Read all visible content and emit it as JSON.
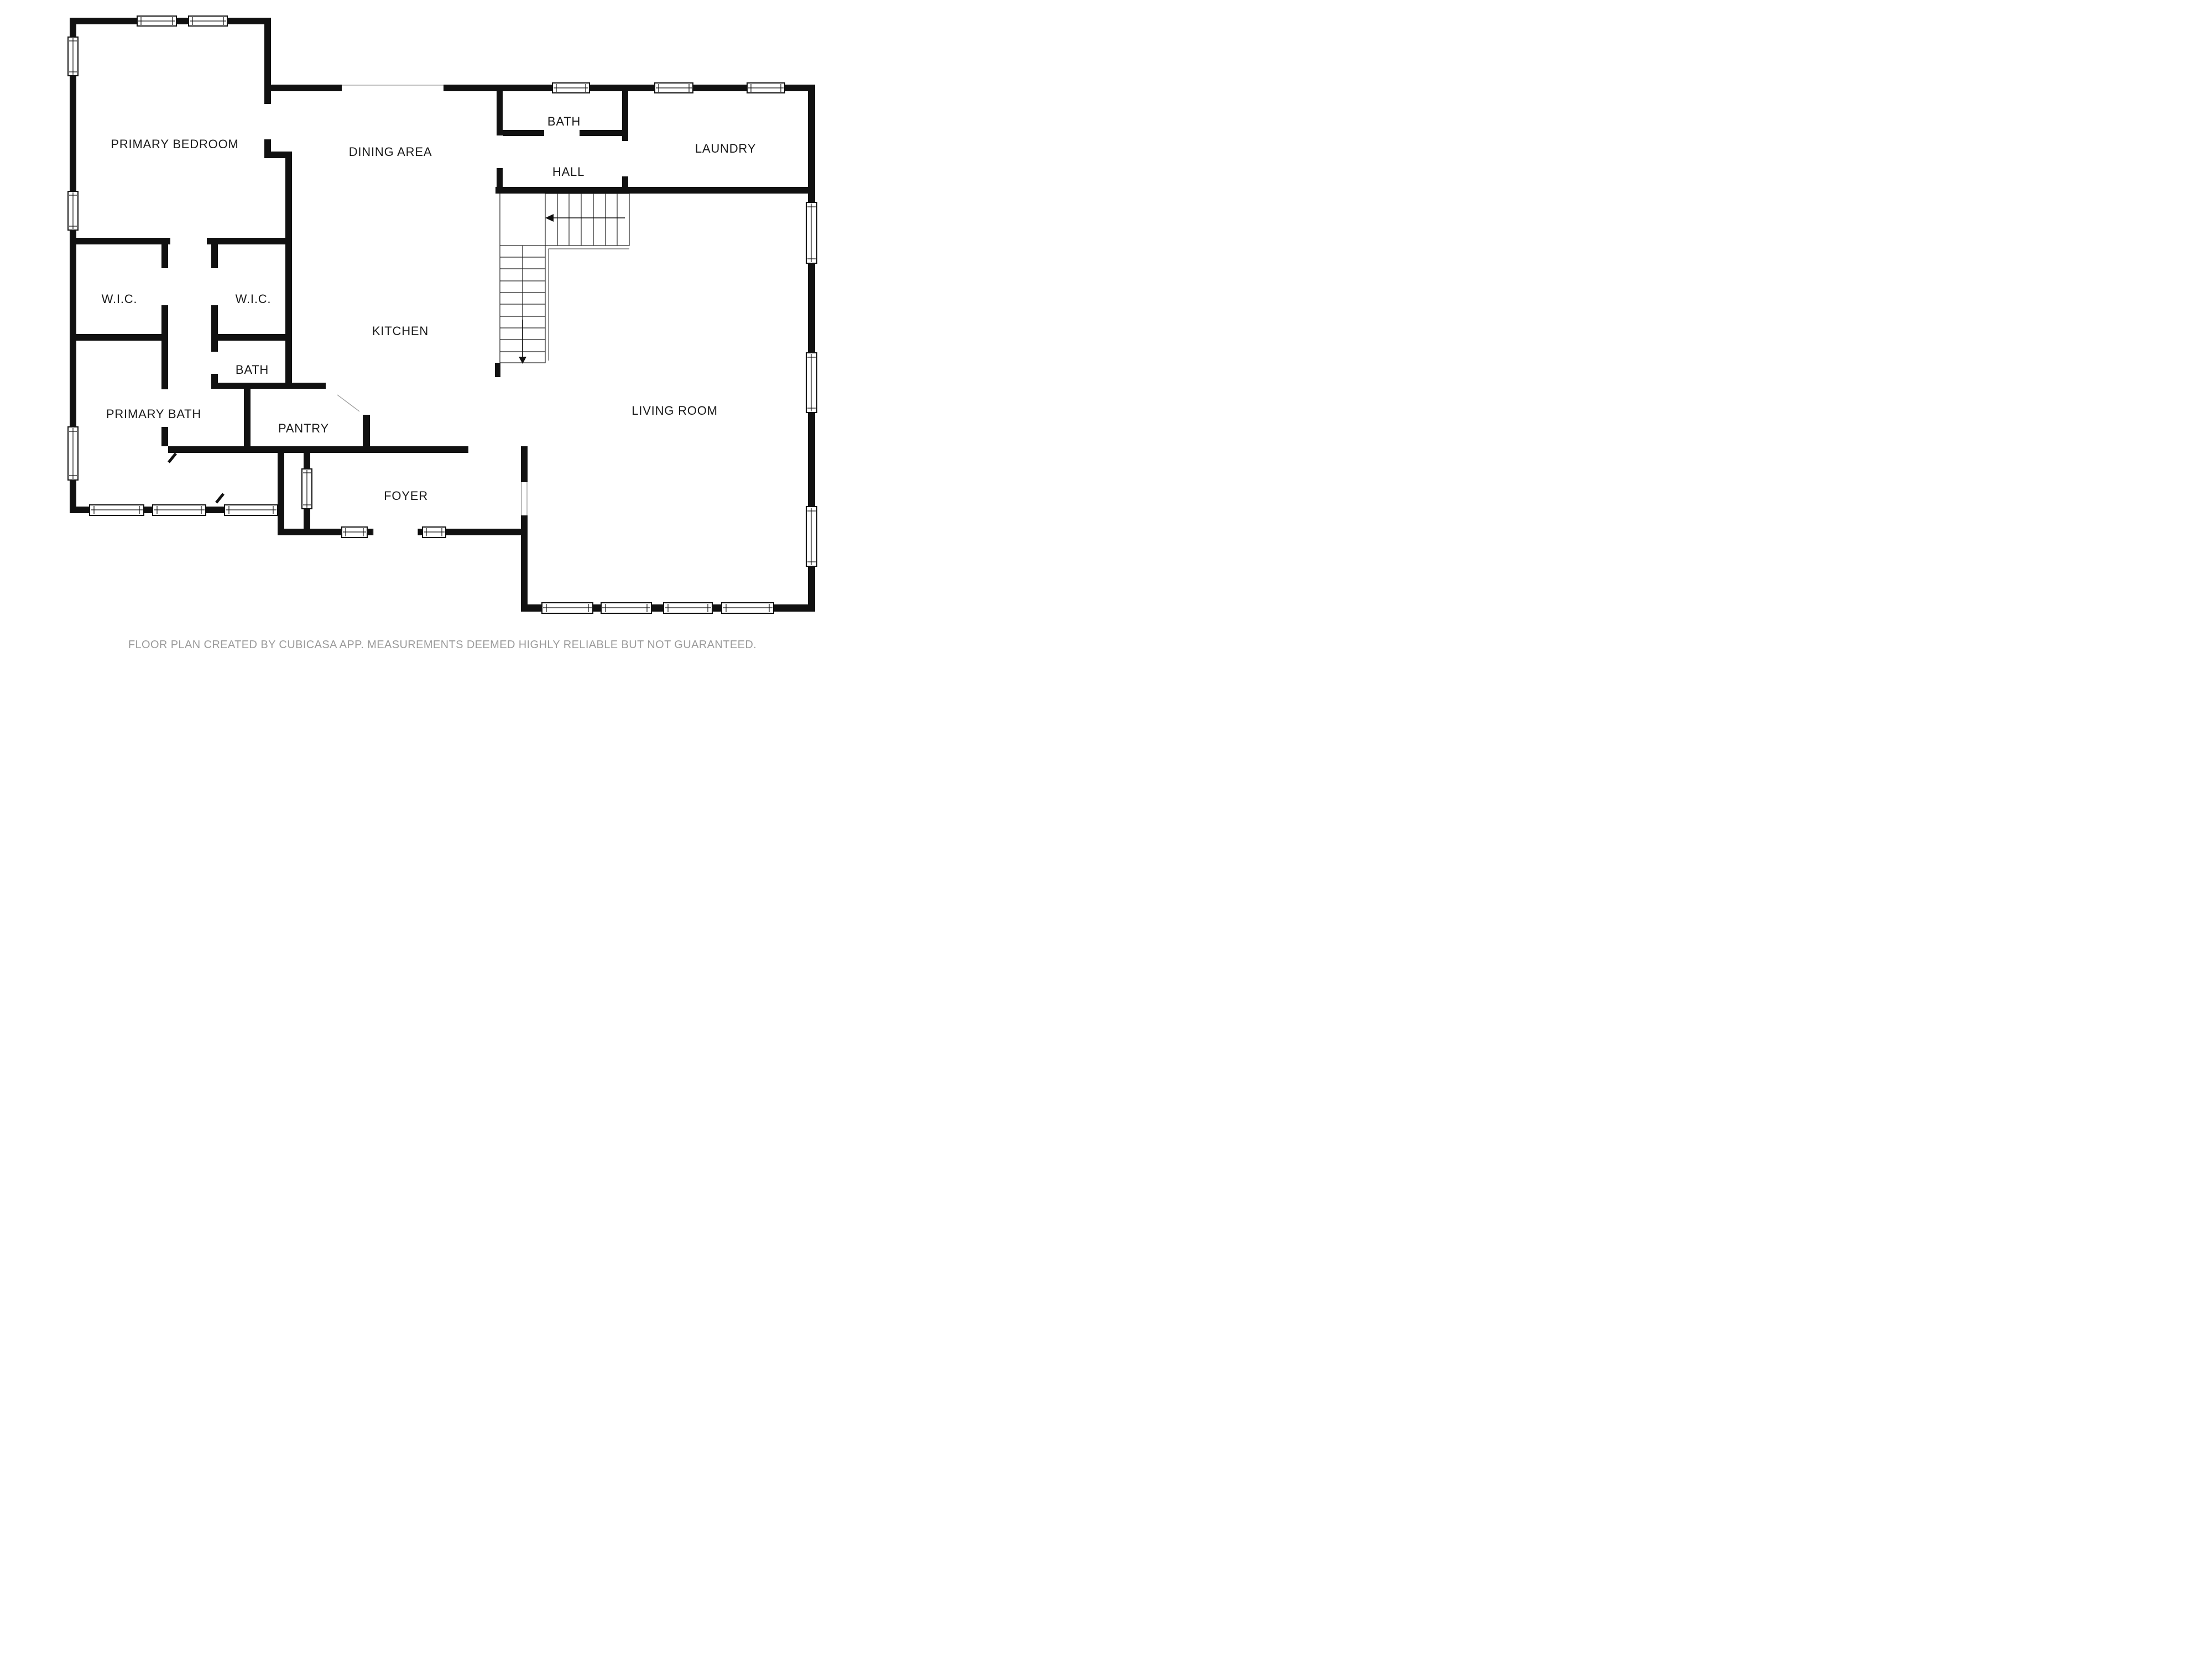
{
  "floor_plan": {
    "rooms": [
      {
        "id": "primary-bedroom",
        "label": "PRIMARY BEDROOM"
      },
      {
        "id": "dining-area",
        "label": "DINING AREA"
      },
      {
        "id": "bath-upper",
        "label": "BATH"
      },
      {
        "id": "hall",
        "label": "HALL"
      },
      {
        "id": "laundry",
        "label": "LAUNDRY"
      },
      {
        "id": "wic-left",
        "label": "W.I.C."
      },
      {
        "id": "wic-right",
        "label": "W.I.C."
      },
      {
        "id": "kitchen",
        "label": "KITCHEN"
      },
      {
        "id": "bath-middle",
        "label": "BATH"
      },
      {
        "id": "primary-bath",
        "label": "PRIMARY BATH"
      },
      {
        "id": "pantry",
        "label": "PANTRY"
      },
      {
        "id": "foyer",
        "label": "FOYER"
      },
      {
        "id": "living-room",
        "label": "LIVING ROOM"
      }
    ],
    "stairs": {
      "upper_run_direction": "left",
      "lower_run_direction": "down"
    },
    "colors": {
      "wall": "#111111",
      "room_label": "#1a1a1a",
      "opening_line": "#9c9c9c",
      "footer_text": "#9b9b9b",
      "background": "#ffffff"
    }
  },
  "footer": {
    "disclaimer": "FLOOR PLAN CREATED BY CUBICASA APP. MEASUREMENTS DEEMED HIGHLY RELIABLE BUT NOT GUARANTEED."
  }
}
